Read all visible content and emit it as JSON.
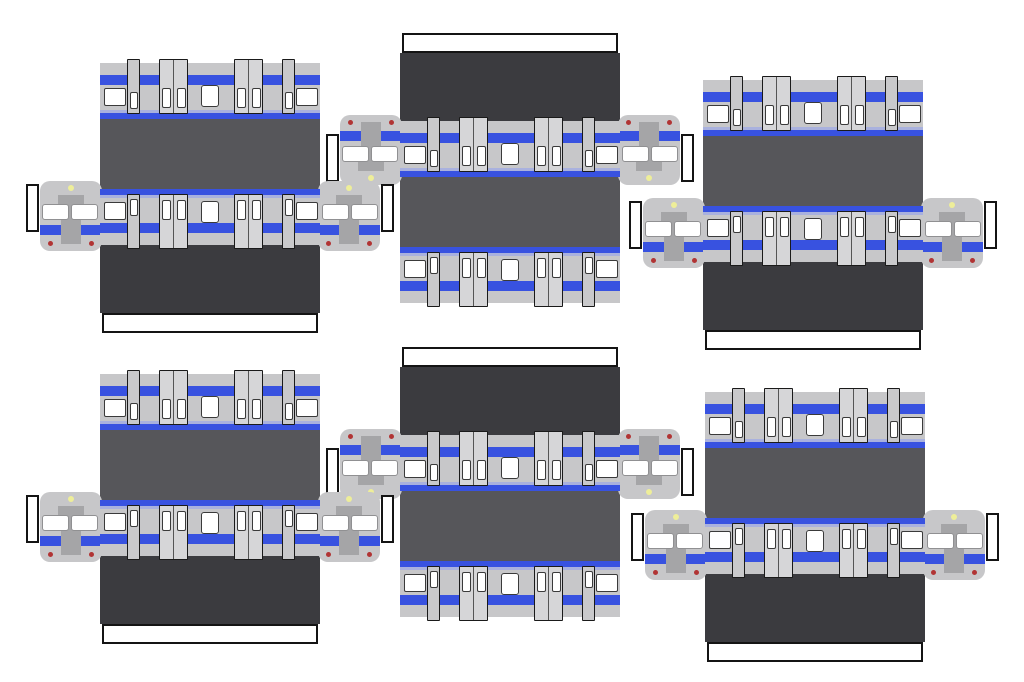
{
  "sheet": {
    "title": "train-papercraft-cutout-sheet",
    "description": "Printable papercraft templates for six commuter train cars with blue-stripe livery; each template has two side panels, roof and underframe panels, two cab-end faces and white glue tabs",
    "width": 1024,
    "height": 682,
    "background": "#FFFFFF",
    "grid_rows": 2,
    "grid_columns": 3,
    "unit_count": 6
  },
  "colors": {
    "car_body_gray": "#C7C7C9",
    "door_gray": "#D6D6D8",
    "narrow_door_gray": "#C9C9CB",
    "stripe_blue": "#3852E0",
    "thin_stripe_blue": "#A9B1DE",
    "roof_gray": "#56565A",
    "underframe_gray": "#3B3B3F",
    "gangway_gray": "#A5A5A7",
    "window_white": "#FFFFFF",
    "outline_dark": "#1A1A1A",
    "glue_tab_white": "#FFFFFF",
    "headlight_yellow": "#EEEE99",
    "taillight_red": "#B13434"
  },
  "panel": {
    "width": 220,
    "body_height": 56,
    "top_stripe": {
      "y": 12,
      "h": 10
    },
    "thin_stripe": {
      "y": 47,
      "h": 2.5
    },
    "bottom_stripe": {
      "y": 49.5,
      "h": 6.5
    },
    "door_top": -4,
    "door_height": 55,
    "elements": [
      {
        "type": "small-window",
        "x": 4,
        "y": 25,
        "w": 22,
        "h": 18
      },
      {
        "type": "narrow-door",
        "x": 27,
        "w": 13
      },
      {
        "type": "door-pair",
        "x": 59,
        "w": 29
      },
      {
        "type": "center-window",
        "x": 101,
        "y": 22,
        "w": 18,
        "h": 22
      },
      {
        "type": "door-pair",
        "x": 134,
        "w": 29
      },
      {
        "type": "narrow-door",
        "x": 182,
        "w": 13
      },
      {
        "type": "small-window",
        "x": 196,
        "y": 25,
        "w": 22,
        "h": 18
      }
    ],
    "pair_window": {
      "y": 28,
      "h": 20,
      "w": 9
    },
    "narrow_window": {
      "y": 32,
      "h": 17,
      "w": 8
    }
  },
  "cab": {
    "width": 62,
    "height": 70,
    "corner_radius": 10,
    "headlight": {
      "x": 28,
      "y": 4,
      "size": 6
    },
    "gangway_shoulder": {
      "x": 18,
      "y": 14,
      "w": 26,
      "h": 13
    },
    "gangway_strip": {
      "x": 21,
      "y": 14,
      "w": 20,
      "h": 49
    },
    "windshield_left": {
      "x": 2,
      "y": 23,
      "w": 27,
      "h": 16
    },
    "windshield_right": {
      "x": 31,
      "y": 23,
      "w": 27,
      "h": 16
    },
    "stripe": {
      "y": 44,
      "h": 10
    },
    "taillight_left": {
      "x": 8,
      "y": 60,
      "size": 5
    },
    "taillight_right": {
      "x": 49,
      "y": 60,
      "size": 5
    },
    "glue_tab": {
      "w": 13,
      "h": 48,
      "y": 3
    },
    "left_cab_offset_x": -60,
    "right_cab_offset_x": 218,
    "offset_y": 118
  },
  "unit_rows": {
    "side_panel_h": 56,
    "roof_y": 56,
    "roof_h": 70,
    "mid_panel_y": 126,
    "underframe_y": 182,
    "underframe_h": 68,
    "glue_tab_y": 250,
    "glue_tab_h": 20,
    "glue_tab_inset": 2,
    "total_h": 270
  },
  "units": [
    {
      "id": "car-1",
      "row": 1,
      "col": 1,
      "x": 100,
      "y": 63,
      "orientation": "upright"
    },
    {
      "id": "car-2",
      "row": 1,
      "col": 2,
      "x": 400,
      "y": 33,
      "orientation": "flipped"
    },
    {
      "id": "car-3",
      "row": 1,
      "col": 3,
      "x": 703,
      "y": 80,
      "orientation": "upright"
    },
    {
      "id": "car-4",
      "row": 2,
      "col": 1,
      "x": 100,
      "y": 374,
      "orientation": "upright"
    },
    {
      "id": "car-5",
      "row": 2,
      "col": 2,
      "x": 400,
      "y": 347,
      "orientation": "flipped"
    },
    {
      "id": "car-6",
      "row": 2,
      "col": 3,
      "x": 705,
      "y": 392,
      "orientation": "upright"
    }
  ]
}
